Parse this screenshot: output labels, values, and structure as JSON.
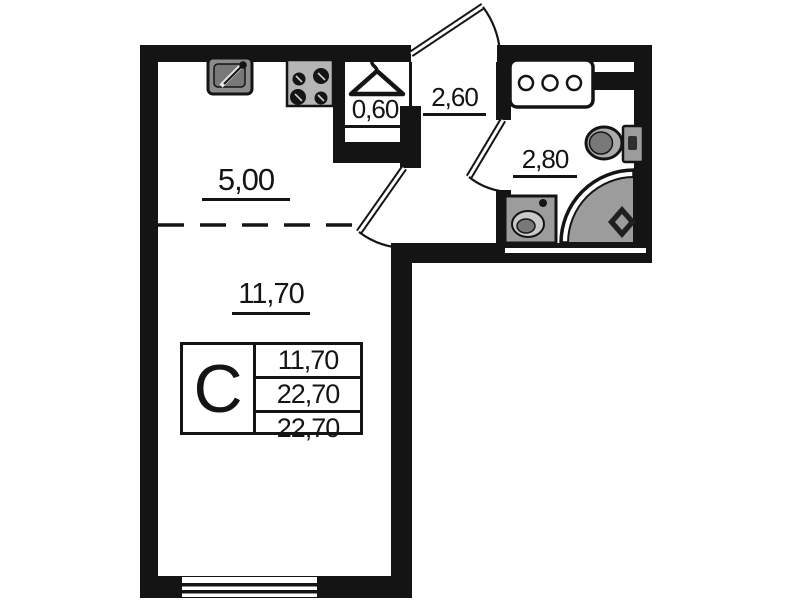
{
  "labels": {
    "kitchen_zone": "5,00",
    "living_zone": "11,70",
    "wardrobe": "0,60",
    "hallway": "2,60",
    "bathroom": "2,80"
  },
  "legend": {
    "type_symbol": "С",
    "values": [
      "11,70",
      "22,70",
      "22,70"
    ]
  },
  "colors": {
    "line": "#141414",
    "fixture": "#9c9c9c",
    "fixture_light": "#c9c9c9",
    "fixture_dark": "#787878",
    "bg": "#ffffff"
  },
  "icons": {
    "kitchen": [
      "kitchen-sink-icon",
      "stove-icon"
    ],
    "wardrobe": [
      "hanger-icon"
    ],
    "bathroom": [
      "shelf-icon",
      "toilet-icon",
      "washbasin-icon",
      "corner-shower-icon"
    ],
    "openings": [
      "entrance-door",
      "room-door",
      "bathroom-door",
      "window"
    ]
  }
}
